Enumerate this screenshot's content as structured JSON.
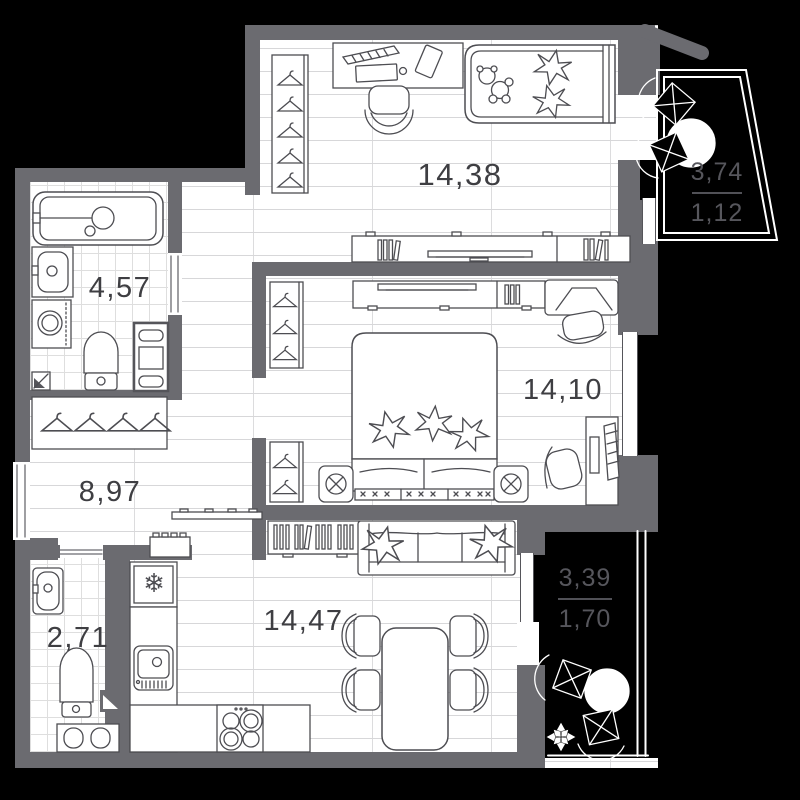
{
  "title": "Apartment floor plan",
  "rooms": {
    "childrens": {
      "name": "children-room",
      "area": "14,38"
    },
    "bathroom": {
      "name": "bathroom",
      "area": "4,57"
    },
    "bedroom": {
      "name": "bedroom",
      "area": "14,10"
    },
    "hallway": {
      "name": "hallway",
      "area": "8,97"
    },
    "wc": {
      "name": "wc",
      "area": "2,71"
    },
    "kitchen_living": {
      "name": "kitchen-living-room",
      "area": "14,47"
    },
    "balcony_top": {
      "name": "balcony-top",
      "area_total": "3,74",
      "area_counted": "1,12"
    },
    "balcony_bottom": {
      "name": "balcony-bottom",
      "area_total": "3,39",
      "area_counted": "1,70"
    }
  },
  "icons": {
    "snowflake": "❄"
  },
  "colors": {
    "wall": "#6b6b70",
    "background": "#000000",
    "floor": "#ffffff",
    "furniture_line": "#4d4d52",
    "label": "#3e3e42",
    "balcony_label": "#56565c"
  }
}
